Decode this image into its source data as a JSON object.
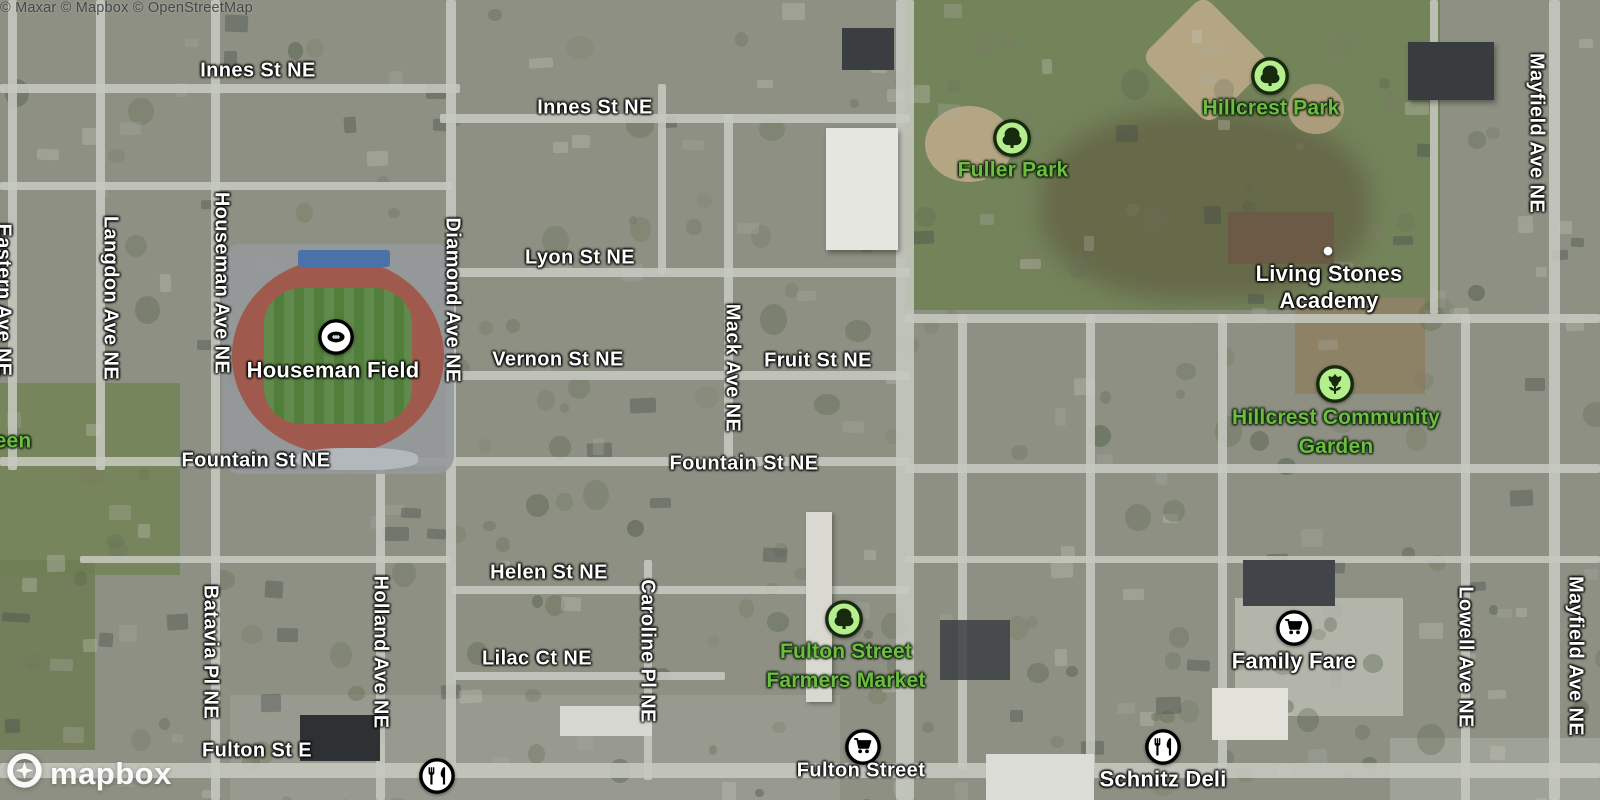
{
  "logo": {
    "wordmark": "mapbox"
  },
  "attribution": {
    "text": "© Maxar © Mapbox © OpenStreetMap"
  },
  "colors": {
    "park_label": "#6dbd45",
    "green_icon_fill": "#b5ef8d",
    "green_icon_stroke": "#172a0d",
    "white_icon_fill": "#ffffff",
    "white_icon_stroke": "#000000"
  },
  "map": {
    "labels": [
      {
        "kind": "street-h",
        "text": "Innes St NE",
        "x": 258,
        "y": 71
      },
      {
        "kind": "street-h",
        "text": "Innes St NE",
        "x": 595,
        "y": 108
      },
      {
        "kind": "street-h",
        "text": "Lyon St NE",
        "x": 580,
        "y": 258
      },
      {
        "kind": "street-h",
        "text": "Vernon St NE",
        "x": 558,
        "y": 360
      },
      {
        "kind": "street-h",
        "text": "Fruit St NE",
        "x": 818,
        "y": 361
      },
      {
        "kind": "street-h",
        "text": "Fountain St NE",
        "x": 256,
        "y": 461
      },
      {
        "kind": "street-h",
        "text": "Fountain St NE",
        "x": 744,
        "y": 464
      },
      {
        "kind": "street-h",
        "text": "Helen St NE",
        "x": 549,
        "y": 573
      },
      {
        "kind": "street-h",
        "text": "Lilac Ct NE",
        "x": 537,
        "y": 659
      },
      {
        "kind": "street-h",
        "text": "Fulton St E",
        "x": 257,
        "y": 751
      },
      {
        "kind": "street-h",
        "text": "Fulton Street",
        "x": 861,
        "y": 771
      },
      {
        "kind": "street-v",
        "text": "Eastern Ave NE",
        "x": 3,
        "y": 300
      },
      {
        "kind": "street-v",
        "text": "Langdon Ave NE",
        "x": 110,
        "y": 298
      },
      {
        "kind": "street-v",
        "text": "Houseman Ave NE",
        "x": 221,
        "y": 283
      },
      {
        "kind": "street-v",
        "text": "Diamond Ave NE",
        "x": 452,
        "y": 300
      },
      {
        "kind": "street-v",
        "text": "Mack Ave NE",
        "x": 732,
        "y": 368
      },
      {
        "kind": "street-v",
        "text": "Batavia Pl NE",
        "x": 210,
        "y": 652
      },
      {
        "kind": "street-v",
        "text": "Holland Ave NE",
        "x": 380,
        "y": 652
      },
      {
        "kind": "street-v",
        "text": "Caroline Pl NE",
        "x": 647,
        "y": 651
      },
      {
        "kind": "street-v",
        "text": "Mayfield Ave NE",
        "x": 1536,
        "y": 133
      },
      {
        "kind": "street-v",
        "text": "Lowell Ave NE",
        "x": 1465,
        "y": 657
      },
      {
        "kind": "street-v",
        "text": "Mayfield Ave NE",
        "x": 1575,
        "y": 656
      },
      {
        "kind": "poi",
        "text": "Houseman Field",
        "x": 333,
        "y": 370
      },
      {
        "kind": "poi",
        "lines": [
          "Living Stones",
          "Academy"
        ],
        "x": 1329,
        "y": 287
      },
      {
        "kind": "poi",
        "text": "Family Fare",
        "x": 1294,
        "y": 661
      },
      {
        "kind": "poi",
        "text": "Schnitz Deli",
        "x": 1163,
        "y": 779
      },
      {
        "kind": "park",
        "text": "Fuller Park",
        "x": 1013,
        "y": 170
      },
      {
        "kind": "park",
        "text": "Hillcrest Park",
        "x": 1271,
        "y": 108
      },
      {
        "kind": "park",
        "lines": [
          "Hillcrest Community",
          "Garden"
        ],
        "x": 1336,
        "y": 432
      },
      {
        "kind": "park",
        "lines": [
          "Fulton Street",
          "Farmers Market"
        ],
        "x": 846,
        "y": 666
      },
      {
        "kind": "park",
        "text": "een",
        "x": 13,
        "y": 441
      }
    ],
    "markers": [
      {
        "icon": "football",
        "name": "houseman-field-stadium-marker",
        "x": 336,
        "y": 337
      },
      {
        "icon": "tree",
        "name": "fuller-park-marker",
        "x": 1012,
        "y": 138
      },
      {
        "icon": "tree",
        "name": "hillcrest-park-marker",
        "x": 1270,
        "y": 76
      },
      {
        "icon": "tree",
        "name": "farmers-market-marker",
        "x": 844,
        "y": 619
      },
      {
        "icon": "garden",
        "name": "hillcrest-community-garden-marker",
        "x": 1335,
        "y": 384
      },
      {
        "icon": "cart",
        "name": "fulton-street-grocery-marker",
        "x": 863,
        "y": 747
      },
      {
        "icon": "cart",
        "name": "family-fare-marker",
        "x": 1294,
        "y": 628
      },
      {
        "icon": "restaurant",
        "name": "schnitz-deli-marker",
        "x": 1163,
        "y": 747
      },
      {
        "icon": "restaurant",
        "name": "fulton-st-restaurant-marker",
        "x": 437,
        "y": 776
      },
      {
        "icon": "dot",
        "name": "living-stones-academy-marker",
        "x": 1328,
        "y": 251
      }
    ]
  }
}
